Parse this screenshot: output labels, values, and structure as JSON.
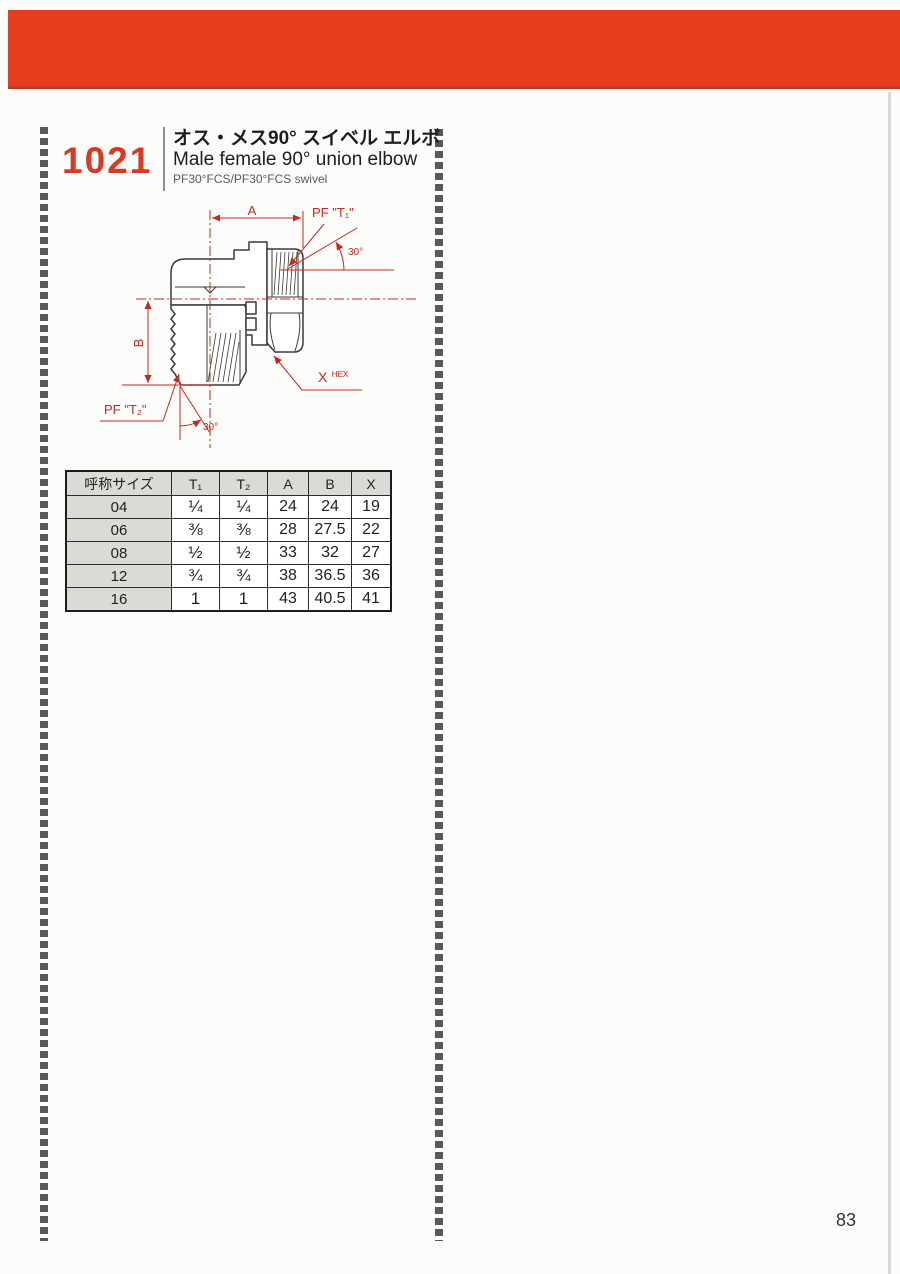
{
  "page": {
    "number": "83"
  },
  "product": {
    "code": "1021",
    "title_ja": "オス・メス90° スイベル エルボ",
    "title_en": "Male female 90° union elbow",
    "subtitle": "PF30°FCS/PF30°FCS swivel"
  },
  "drawing": {
    "labels": {
      "dim_a": "A",
      "dim_b": "B",
      "pf_t1": "PF \"T₁\"",
      "pf_t2": "PF \"T₂\"",
      "angle_top": "30°",
      "angle_bottom": "30°",
      "hex_x": "X",
      "hex_sup": "HEX"
    },
    "colors": {
      "annotation": "#c5281c",
      "outline": "#3a3a3a"
    }
  },
  "table": {
    "headers": [
      "呼称サイズ",
      "T₁",
      "T₂",
      "A",
      "B",
      "X"
    ],
    "rows": [
      [
        "04",
        "¼",
        "¼",
        "24",
        "24",
        "19"
      ],
      [
        "06",
        "⅜",
        "⅜",
        "28",
        "27.5",
        "22"
      ],
      [
        "08",
        "½",
        "½",
        "33",
        "32",
        "27"
      ],
      [
        "12",
        "¾",
        "¾",
        "38",
        "36.5",
        "36"
      ],
      [
        "16",
        "1",
        "1",
        "43",
        "40.5",
        "41"
      ]
    ]
  },
  "theme": {
    "accent_red": "#e73c1d",
    "table_shade": "#dcdad7"
  }
}
